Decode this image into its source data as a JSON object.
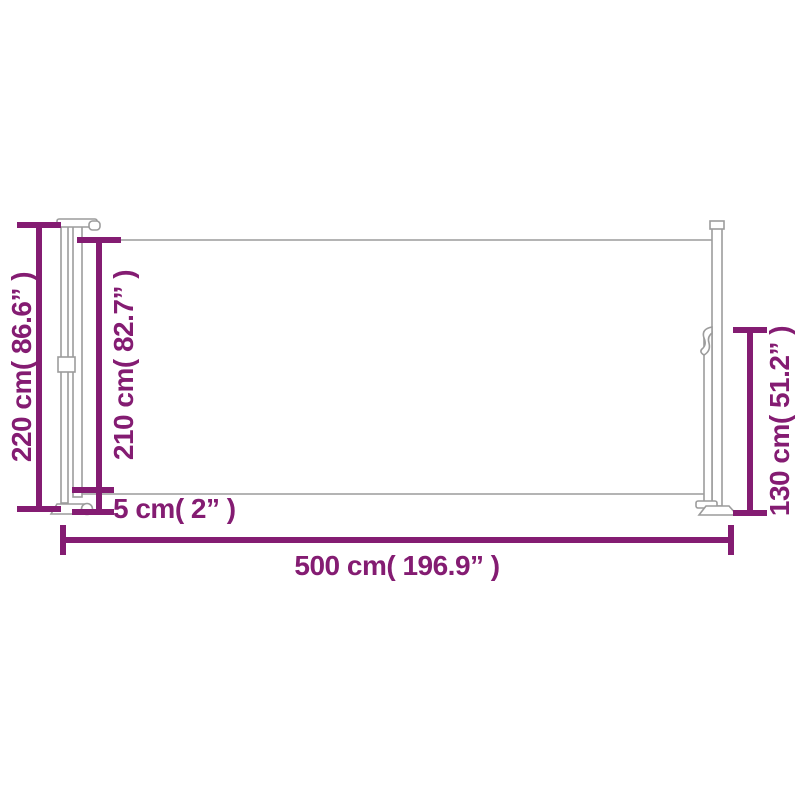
{
  "page": {
    "background": "#ffffff"
  },
  "colors": {
    "dimension_accent": "#841c72",
    "product_outline": "#9c9c9c"
  },
  "diagram": {
    "kind": "product-dimension-diagram",
    "subject": "retractable side awning, side view",
    "dimensions": [
      {
        "id": "total-height",
        "cm": 220,
        "inches": 86.6,
        "orientation": "vertical",
        "label": "220 cm( 86.6” )"
      },
      {
        "id": "fabric-height",
        "cm": 210,
        "inches": 82.7,
        "orientation": "vertical",
        "label": "210 cm( 82.7” )"
      },
      {
        "id": "bottom-gap",
        "cm": 5,
        "inches": 2,
        "orientation": "vertical",
        "label": "5 cm( 2” )"
      },
      {
        "id": "total-length",
        "cm": 500,
        "inches": 196.9,
        "orientation": "horizontal",
        "label": "500 cm( 196.9” )"
      },
      {
        "id": "handle-height",
        "cm": 130,
        "inches": 51.2,
        "orientation": "vertical",
        "label": "130 cm( 51.2” )"
      }
    ]
  }
}
